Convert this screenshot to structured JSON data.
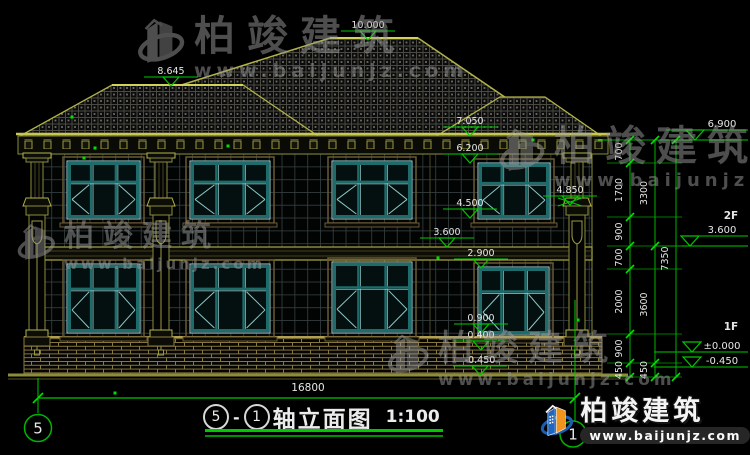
{
  "watermark": {
    "brand": "柏竣建筑",
    "url": "www.baijunjz.com"
  },
  "logo": {
    "brand": "柏竣建筑",
    "url": "www.baijunjz.com"
  },
  "title": {
    "axis_start": "5",
    "separator": "-",
    "axis_end": "1",
    "name": "轴立面图",
    "scale": "1:100"
  },
  "markers": {
    "left": [
      "10.000",
      "8.645",
      "7.050",
      "6.200",
      "4.850",
      "4.500",
      "3.600",
      "2.900",
      "0.900",
      "0.400",
      "-0.450"
    ]
  },
  "right": {
    "eave": "6.900",
    "floor2_label": "2F",
    "floor2_elev": "3.600",
    "floor1_label": "1F",
    "floor1_elev": "±0.000",
    "ground_elev": "-0.450",
    "chain_inner": [
      "700",
      "1700",
      "900",
      "700",
      "2000",
      "900",
      "450"
    ],
    "chain_mid": [
      "3300",
      "3600",
      "450"
    ],
    "chain_outer": "7350"
  },
  "bottom": {
    "total_width": "16800",
    "axis_left": "5",
    "axis_right": "1"
  }
}
